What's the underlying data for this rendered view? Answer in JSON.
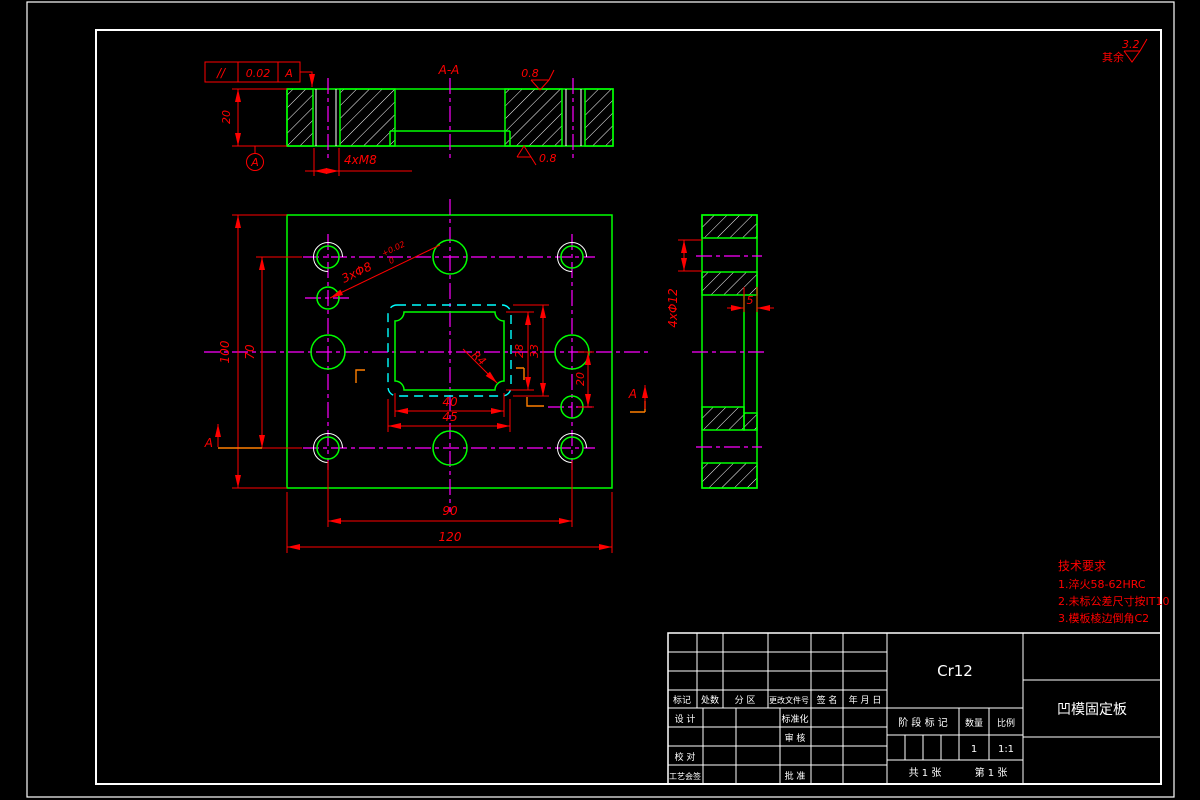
{
  "colors": {
    "outline": "#00ff00",
    "dimension": "#ff0000",
    "centerline": "#ff00ff",
    "hidden_line": "#00ffff",
    "frame": "#ffffff",
    "section_mark": "#ff7f00",
    "background": "#000000"
  },
  "labels": {
    "section_title": "A-A",
    "tol_symbol": "//",
    "tol_value": "0.02",
    "tol_datum": "A",
    "dim_thickness": "20",
    "dim_thread": "4xM8",
    "datum": "A",
    "rough_top": "0.8",
    "rough_bottom": "0.8",
    "dim_height": "100",
    "dim_row_span": "70",
    "dim_col_span": "90",
    "dim_width": "120",
    "dim_cav_w_in": "40",
    "dim_cav_w_out": "45",
    "dim_cav_h_in": "28",
    "dim_cav_h_out": "33",
    "dim_dowel": "20",
    "dowel_label": "3xΦ8",
    "dowel_tol_up": "+0.02",
    "dowel_tol_dn": "0",
    "radius": "R4",
    "sec_a_left": "A",
    "sec_a_right": "A",
    "dim_side_holes": "4xΦ12",
    "dim_step": "5",
    "rough_rest_prefix": "其余",
    "rough_rest_value": "3.2"
  },
  "tech_requirements": {
    "title": "技术要求",
    "item1": "1.淬火58-62HRC",
    "item2": "2.未标公差尺寸按IT10",
    "item3": "3.模板棱边倒角C2"
  },
  "title_block": {
    "material": "Cr12",
    "part_name": "凹模固定板",
    "rev_headers": [
      "标记",
      "处数",
      "分 区",
      "更改文件号",
      "签 名",
      "年 月 日"
    ],
    "row_design": "设 计",
    "row_standard": "标准化",
    "row_review": "审 核",
    "row_check": "校 对",
    "row_process": "工艺会签",
    "row_approve": "批 准",
    "stage_header": "阶 段 标 记",
    "qty_header": "数量",
    "scale_header": "比例",
    "qty_value": "1",
    "scale_value": "1:1",
    "sheet_total": "共 1 张",
    "sheet_number": "第 1 张"
  }
}
